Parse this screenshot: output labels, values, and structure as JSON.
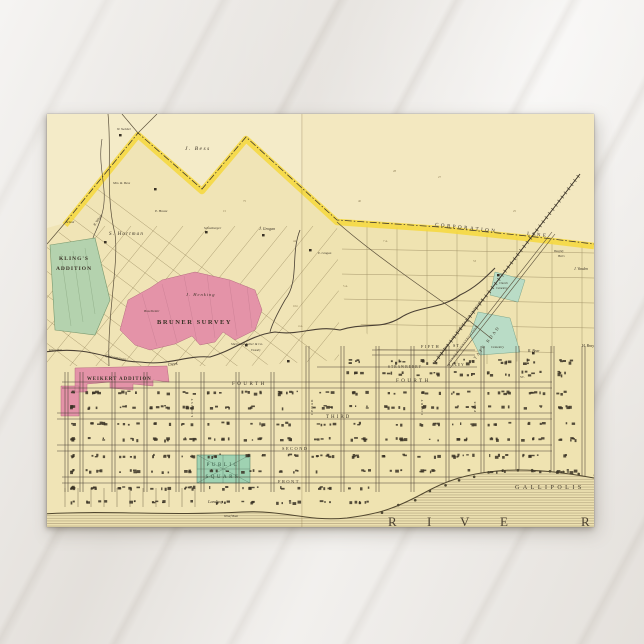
{
  "scene": {
    "description_colors": {
      "background": "#eae7e3",
      "card_paper": "#f0e4b6",
      "corporation_yellow": "#f6d83c",
      "addition_green": "#b4d2ae",
      "square_green": "#9fd2b2",
      "survey_pink": "#e493a8",
      "ink": "#3a3226",
      "faint_ink": "#8d7d55",
      "square_text": "#31523f",
      "river_text": "#4a4030",
      "parcel_line": "#9d8d63",
      "river_hatch": "#8a7a58"
    }
  },
  "map": {
    "labels": [
      {
        "t": "W. Swisher",
        "x": 70,
        "y": 16,
        "s": 3.2,
        "i": 1
      },
      {
        "t": "J. Bess",
        "x": 138,
        "y": 36,
        "s": 5.5,
        "i": 1,
        "ls": 1.5
      },
      {
        "t": "Mrs. R. Bess",
        "x": 66,
        "y": 70,
        "s": 3.4,
        "i": 1
      },
      {
        "t": "E. House",
        "x": 108,
        "y": 98,
        "s": 3.4,
        "i": 1
      },
      {
        "t": "B. Wilson",
        "x": 48,
        "y": 112,
        "s": 3.4,
        "i": 1,
        "r": -55
      },
      {
        "t": "School",
        "x": 19,
        "y": 109,
        "s": 3,
        "i": 1
      },
      {
        "t": "S. Hartman",
        "x": 62,
        "y": 121,
        "s": 5,
        "i": 1,
        "ls": 1.2
      },
      {
        "t": "Schonberger",
        "x": 157,
        "y": 115,
        "s": 3.4,
        "i": 1
      },
      {
        "t": "J. Grogan",
        "x": 212,
        "y": 116,
        "s": 4,
        "i": 1
      },
      {
        "t": "E. Grogan",
        "x": 271,
        "y": 140,
        "s": 3.2,
        "i": 1
      },
      {
        "t": "KLING'S",
        "x": 27,
        "y": 146,
        "s": 5.5,
        "w": 1,
        "ls": 1,
        "a": "m"
      },
      {
        "t": "ADDITION",
        "x": 27,
        "y": 156,
        "s": 5.5,
        "w": 1,
        "ls": 1,
        "a": "m"
      },
      {
        "t": "CORPORATION",
        "x": 388,
        "y": 112,
        "s": 5,
        "ls": 2.5,
        "r": 6
      },
      {
        "t": "LINE",
        "x": 480,
        "y": 121,
        "s": 5,
        "ls": 2.5,
        "r": 6
      },
      {
        "t": "Beeghly",
        "x": 507,
        "y": 138,
        "s": 3,
        "i": 1
      },
      {
        "t": "Heirs",
        "x": 511,
        "y": 143,
        "s": 3,
        "i": 1
      },
      {
        "t": "J. Vanden",
        "x": 527,
        "y": 156,
        "s": 3.6,
        "i": 1
      },
      {
        "t": "Church",
        "x": 452,
        "y": 170,
        "s": 3,
        "i": 1
      },
      {
        "t": "Cemetery",
        "x": 449,
        "y": 175,
        "s": 3,
        "i": 1
      },
      {
        "t": "GALLIPOLIS McARTHUR & COLUMBUS R.R.",
        "x": 392,
        "y": 244,
        "s": 3,
        "r": -53,
        "ls": 0.4
      },
      {
        "t": "UNDER CONSTRUCTION",
        "x": 404,
        "y": 248,
        "s": 3,
        "r": -53,
        "ls": 0.6
      },
      {
        "t": "STATE ROAD",
        "x": 426,
        "y": 249,
        "s": 4.2,
        "r": -53,
        "ls": 2
      },
      {
        "t": "FIFTH",
        "x": 374,
        "y": 234,
        "s": 4.2,
        "ls": 1.5
      },
      {
        "t": "ST.",
        "x": 406,
        "y": 233,
        "s": 4.2,
        "ls": 1
      },
      {
        "t": "Cemetery",
        "x": 444,
        "y": 234,
        "s": 3.4,
        "i": 1
      },
      {
        "t": "R. Bear",
        "x": 481,
        "y": 238,
        "s": 3.8,
        "i": 1
      },
      {
        "t": "H. Bray",
        "x": 535,
        "y": 233,
        "s": 3.8,
        "i": 1
      },
      {
        "t": "J. Henking",
        "x": 139,
        "y": 182,
        "s": 4.5,
        "i": 1,
        "ls": 1
      },
      {
        "t": "Brachletter",
        "x": 97,
        "y": 198,
        "s": 3.4,
        "i": 1
      },
      {
        "t": "BRUNER SURVEY",
        "x": 110,
        "y": 210,
        "s": 6.5,
        "w": 1,
        "ls": 1.5
      },
      {
        "t": "Chicamauga",
        "x": 58,
        "y": 243,
        "s": 4.2,
        "i": 1,
        "r": 10
      },
      {
        "t": "Creek",
        "x": 121,
        "y": 252,
        "s": 4.2,
        "i": 1,
        "r": -8
      },
      {
        "t": "Kling Mill",
        "x": 2,
        "y": 237,
        "s": 3,
        "i": 1
      },
      {
        "t": "WEIKERT ADDITION",
        "x": 40,
        "y": 266,
        "s": 4.8,
        "w": 1,
        "ls": 1
      },
      {
        "t": "Sherwood Fuller & Co.",
        "x": 184,
        "y": 231,
        "s": 3.4,
        "i": 1
      },
      {
        "t": "Foundry",
        "x": 204,
        "y": 237,
        "s": 2.8,
        "i": 1
      },
      {
        "t": "STRAWBERRY",
        "x": 341,
        "y": 254,
        "s": 3.6,
        "ls": 1
      },
      {
        "t": "ALLEY",
        "x": 401,
        "y": 252,
        "s": 3.6,
        "ls": 1
      },
      {
        "t": "FOURTH",
        "x": 185,
        "y": 271,
        "s": 5,
        "ls": 2.5
      },
      {
        "t": "FOURTH",
        "x": 349,
        "y": 268,
        "s": 5,
        "ls": 2.5
      },
      {
        "t": "THIRD",
        "x": 279,
        "y": 304,
        "s": 5,
        "ls": 2
      },
      {
        "t": "SECOND",
        "x": 235,
        "y": 336,
        "s": 4.4,
        "ls": 1.5
      },
      {
        "t": "FRONT",
        "x": 231,
        "y": 369,
        "s": 4.4,
        "ls": 1.5
      },
      {
        "t": "ST.",
        "x": 473,
        "y": 264,
        "s": 3.4
      },
      {
        "t": "LOCUST",
        "x": 146,
        "y": 303,
        "s": 3.4,
        "r": -90,
        "ls": 1
      },
      {
        "t": "CEDAR",
        "x": 266,
        "y": 301,
        "s": 3.4,
        "r": -90,
        "ls": 1
      },
      {
        "t": "COURT",
        "x": 376,
        "y": 301,
        "s": 3.4,
        "r": -90,
        "ls": 1
      },
      {
        "t": "PINE",
        "x": 429,
        "y": 298,
        "s": 3.4,
        "r": -90,
        "ls": 1
      },
      {
        "t": "PUBLIC",
        "x": 176,
        "y": 352,
        "s": 5,
        "ls": 2.5,
        "c": "sq",
        "a": "m"
      },
      {
        "t": "SQUARE",
        "x": 176,
        "y": 364,
        "s": 5,
        "ls": 2.5,
        "c": "sq",
        "a": "m"
      },
      {
        "t": "Landing",
        "x": 161,
        "y": 389,
        "s": 4.4,
        "i": 1
      },
      {
        "t": "Wharf Boat",
        "x": 177,
        "y": 403,
        "s": 3,
        "i": 1
      },
      {
        "t": "GALLIPOLIS",
        "x": 468,
        "y": 375,
        "s": 6,
        "ls": 3.5
      },
      {
        "t": "R",
        "x": 341,
        "y": 412,
        "s": 13,
        "c": "riv"
      },
      {
        "t": "I",
        "x": 380,
        "y": 412,
        "s": 13,
        "c": "riv"
      },
      {
        "t": "V",
        "x": 413,
        "y": 412,
        "s": 13,
        "c": "riv"
      },
      {
        "t": "E",
        "x": 453,
        "y": 412,
        "s": 13,
        "c": "riv"
      },
      {
        "t": "R",
        "x": 534,
        "y": 412,
        "s": 13,
        "c": "riv"
      },
      {
        "t": "27",
        "x": 391,
        "y": 64,
        "s": 3,
        "c": "f"
      },
      {
        "t": "28",
        "x": 346,
        "y": 58,
        "s": 3,
        "c": "f"
      },
      {
        "t": "53",
        "x": 426,
        "y": 148,
        "s": 3,
        "c": "f"
      },
      {
        "t": "25",
        "x": 466,
        "y": 98,
        "s": 3,
        "c": "f"
      },
      {
        "t": "104",
        "x": 246,
        "y": 193,
        "s": 3,
        "c": "f"
      },
      {
        "t": "4 A.",
        "x": 251,
        "y": 213,
        "s": 3,
        "c": "f"
      },
      {
        "t": "5 A.",
        "x": 296,
        "y": 173,
        "s": 3,
        "c": "f"
      },
      {
        "t": "75",
        "x": 196,
        "y": 88,
        "s": 3,
        "c": "f"
      },
      {
        "t": "40",
        "x": 311,
        "y": 88,
        "s": 3,
        "c": "f"
      },
      {
        "t": "7 A.",
        "x": 336,
        "y": 128,
        "s": 3,
        "c": "f"
      },
      {
        "t": "44",
        "x": 246,
        "y": 128,
        "s": 3,
        "c": "f"
      },
      {
        "t": "15",
        "x": 176,
        "y": 98,
        "s": 3,
        "c": "f"
      }
    ]
  }
}
